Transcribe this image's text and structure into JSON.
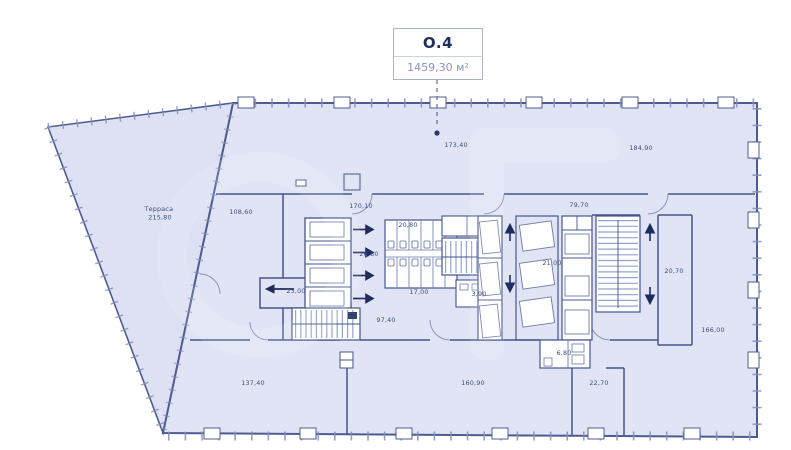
{
  "unit": {
    "code": "O.4",
    "area": "1459,30 м²"
  },
  "terrace": {
    "name": "Терраса",
    "area": "215,80"
  },
  "rooms": {
    "open_top_left": "173,40",
    "open_top_right": "184,90",
    "left_zone": "108,60",
    "corridor_top": "170,10",
    "corridor_right": "79,70",
    "wc_top": "20,80",
    "elevator_lobby": "26,80",
    "wc_bottom": "17,00",
    "shaft_mid": "21,00",
    "room_right": "20,70",
    "entrance": "23,00",
    "closet": "3,90",
    "corridor_core": "97,40",
    "wc_small": "6,80",
    "open_right": "166,00",
    "open_bottom_left": "137,40",
    "open_bottom": "160,90",
    "corridor_bottom": "22,70"
  },
  "colors": {
    "floor_fill": "#e1e4f5",
    "terrace_fill": "#dde1f3",
    "wall_stroke": "#46558c",
    "light_stroke": "#6d7aa8",
    "accent_dark": "#1e2c5e",
    "label_text": "#3e4d7e",
    "badge_title": "#20305e",
    "badge_area": "#8a95ba"
  }
}
